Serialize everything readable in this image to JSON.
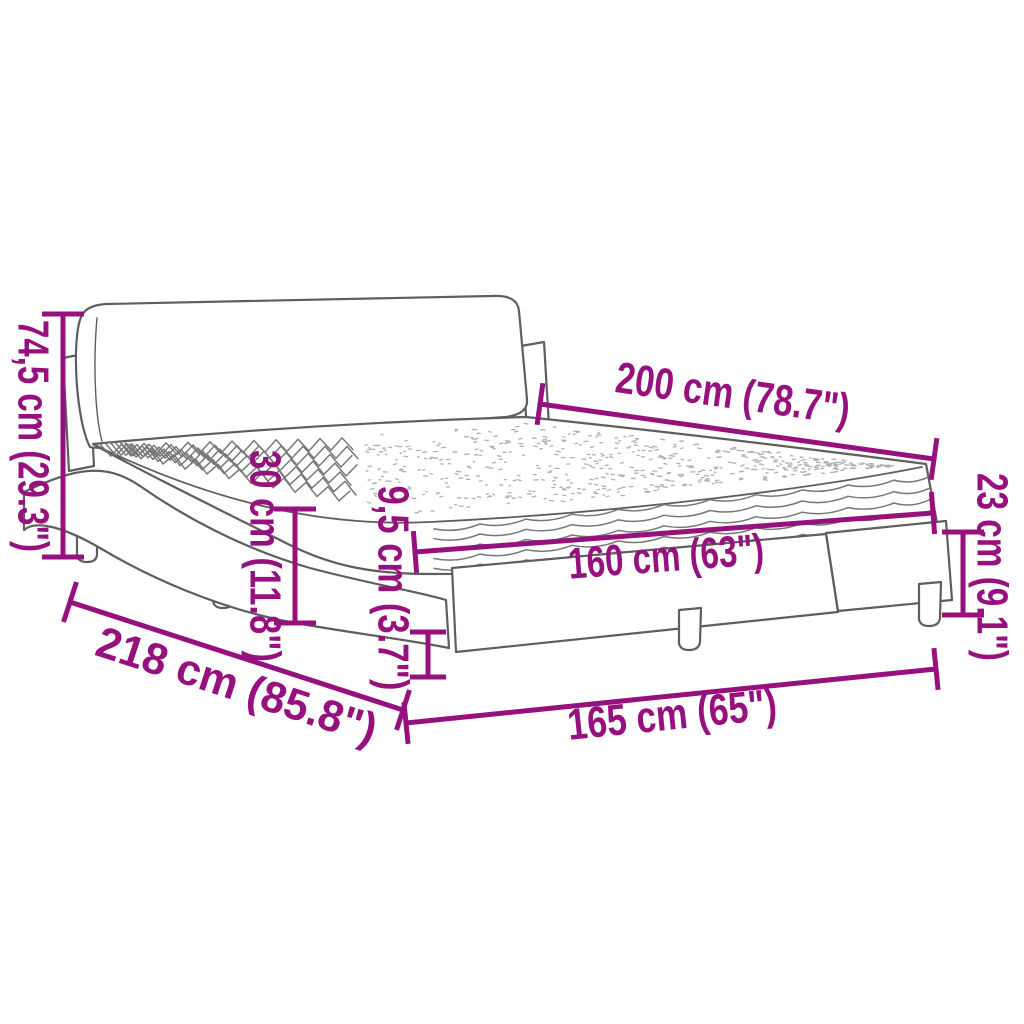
{
  "diagram": {
    "kind": "product-dimension-diagram",
    "subject": "bed-frame-with-mattress-and-headboard",
    "background_color": "#ffffff",
    "accent_color": "#96117E",
    "line_art_color": "#5e5e5e",
    "dimensions": [
      {
        "id": "headboard-height",
        "label": "74,5 cm (29.3\")",
        "value_cm": 74.5,
        "value_in": 29.3,
        "orientation": "vertical-left"
      },
      {
        "id": "bed-length",
        "label": "200 cm (78.7\")",
        "value_cm": 200,
        "value_in": 78.7,
        "orientation": "diagonal-top-right"
      },
      {
        "id": "frame-side-height",
        "label": "30 cm (11.8\")",
        "value_cm": 30,
        "value_in": 11.8,
        "orientation": "vertical-middle"
      },
      {
        "id": "rail-thickness",
        "label": "9,5 cm (3.7\")",
        "value_cm": 9.5,
        "value_in": 3.7,
        "orientation": "vertical-middle"
      },
      {
        "id": "mattress-width",
        "label": "160 cm (63\")",
        "value_cm": 160,
        "value_in": 63,
        "orientation": "diagonal-on-mattress"
      },
      {
        "id": "foot-end-height",
        "label": "23 cm (9.1\")",
        "value_cm": 23,
        "value_in": 9.1,
        "orientation": "vertical-right"
      },
      {
        "id": "total-length",
        "label": "218 cm (85.8\")",
        "value_cm": 218,
        "value_in": 85.8,
        "orientation": "diagonal-bottom-left"
      },
      {
        "id": "total-width",
        "label": "165 cm (65\")",
        "value_cm": 165,
        "value_in": 65,
        "orientation": "diagonal-bottom"
      }
    ]
  }
}
